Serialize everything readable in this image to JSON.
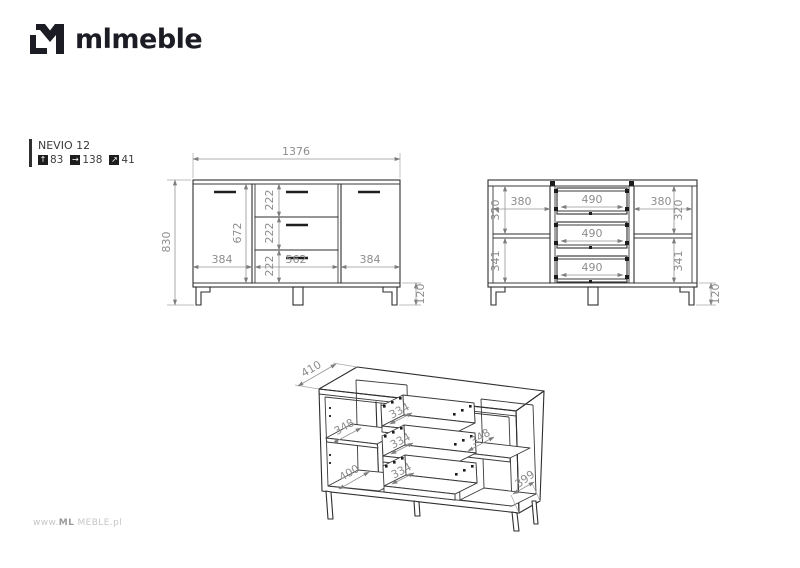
{
  "brand": {
    "logo_text": "mlmeble"
  },
  "product": {
    "name": "NEVIO 12",
    "dimensions_cm": {
      "height": "83",
      "width": "138",
      "depth": "41"
    },
    "icons": {
      "height_icon": "↑",
      "width_icon": "→",
      "depth_icon": "↗"
    }
  },
  "views": {
    "front": {
      "width": "1376",
      "height": "830",
      "door_inner_height": "672",
      "drawer_height_1": "222",
      "drawer_height_2": "222",
      "drawer_height_3": "222",
      "left_door_width": "384",
      "drawer_section_width": "562",
      "right_door_width": "384",
      "leg_height": "120"
    },
    "open": {
      "left_top_height": "320",
      "left_width": "380",
      "left_bottom_height": "341",
      "drawer_width_1": "490",
      "drawer_width_2": "490",
      "drawer_width_3": "490",
      "right_width": "380",
      "right_top_height": "320",
      "right_bottom_height": "341",
      "leg_height": "120"
    },
    "iso": {
      "top_depth": "410",
      "left_shelf_depth": "348",
      "bottom_depth": "400",
      "drawer_depth_1": "334",
      "drawer_depth_2": "334",
      "drawer_depth_3": "334",
      "right_shelf_depth": "348",
      "side_depth": "399"
    }
  },
  "watermark": {
    "prefix": "www.",
    "brand": "ML",
    "middle": " MEBLE",
    "suffix": ".pl"
  },
  "colors": {
    "ink": "#2e2e2e",
    "dimension_text": "#8d8d8d",
    "logo": "#1c1c24",
    "watermark": "#c6c6c6"
  }
}
